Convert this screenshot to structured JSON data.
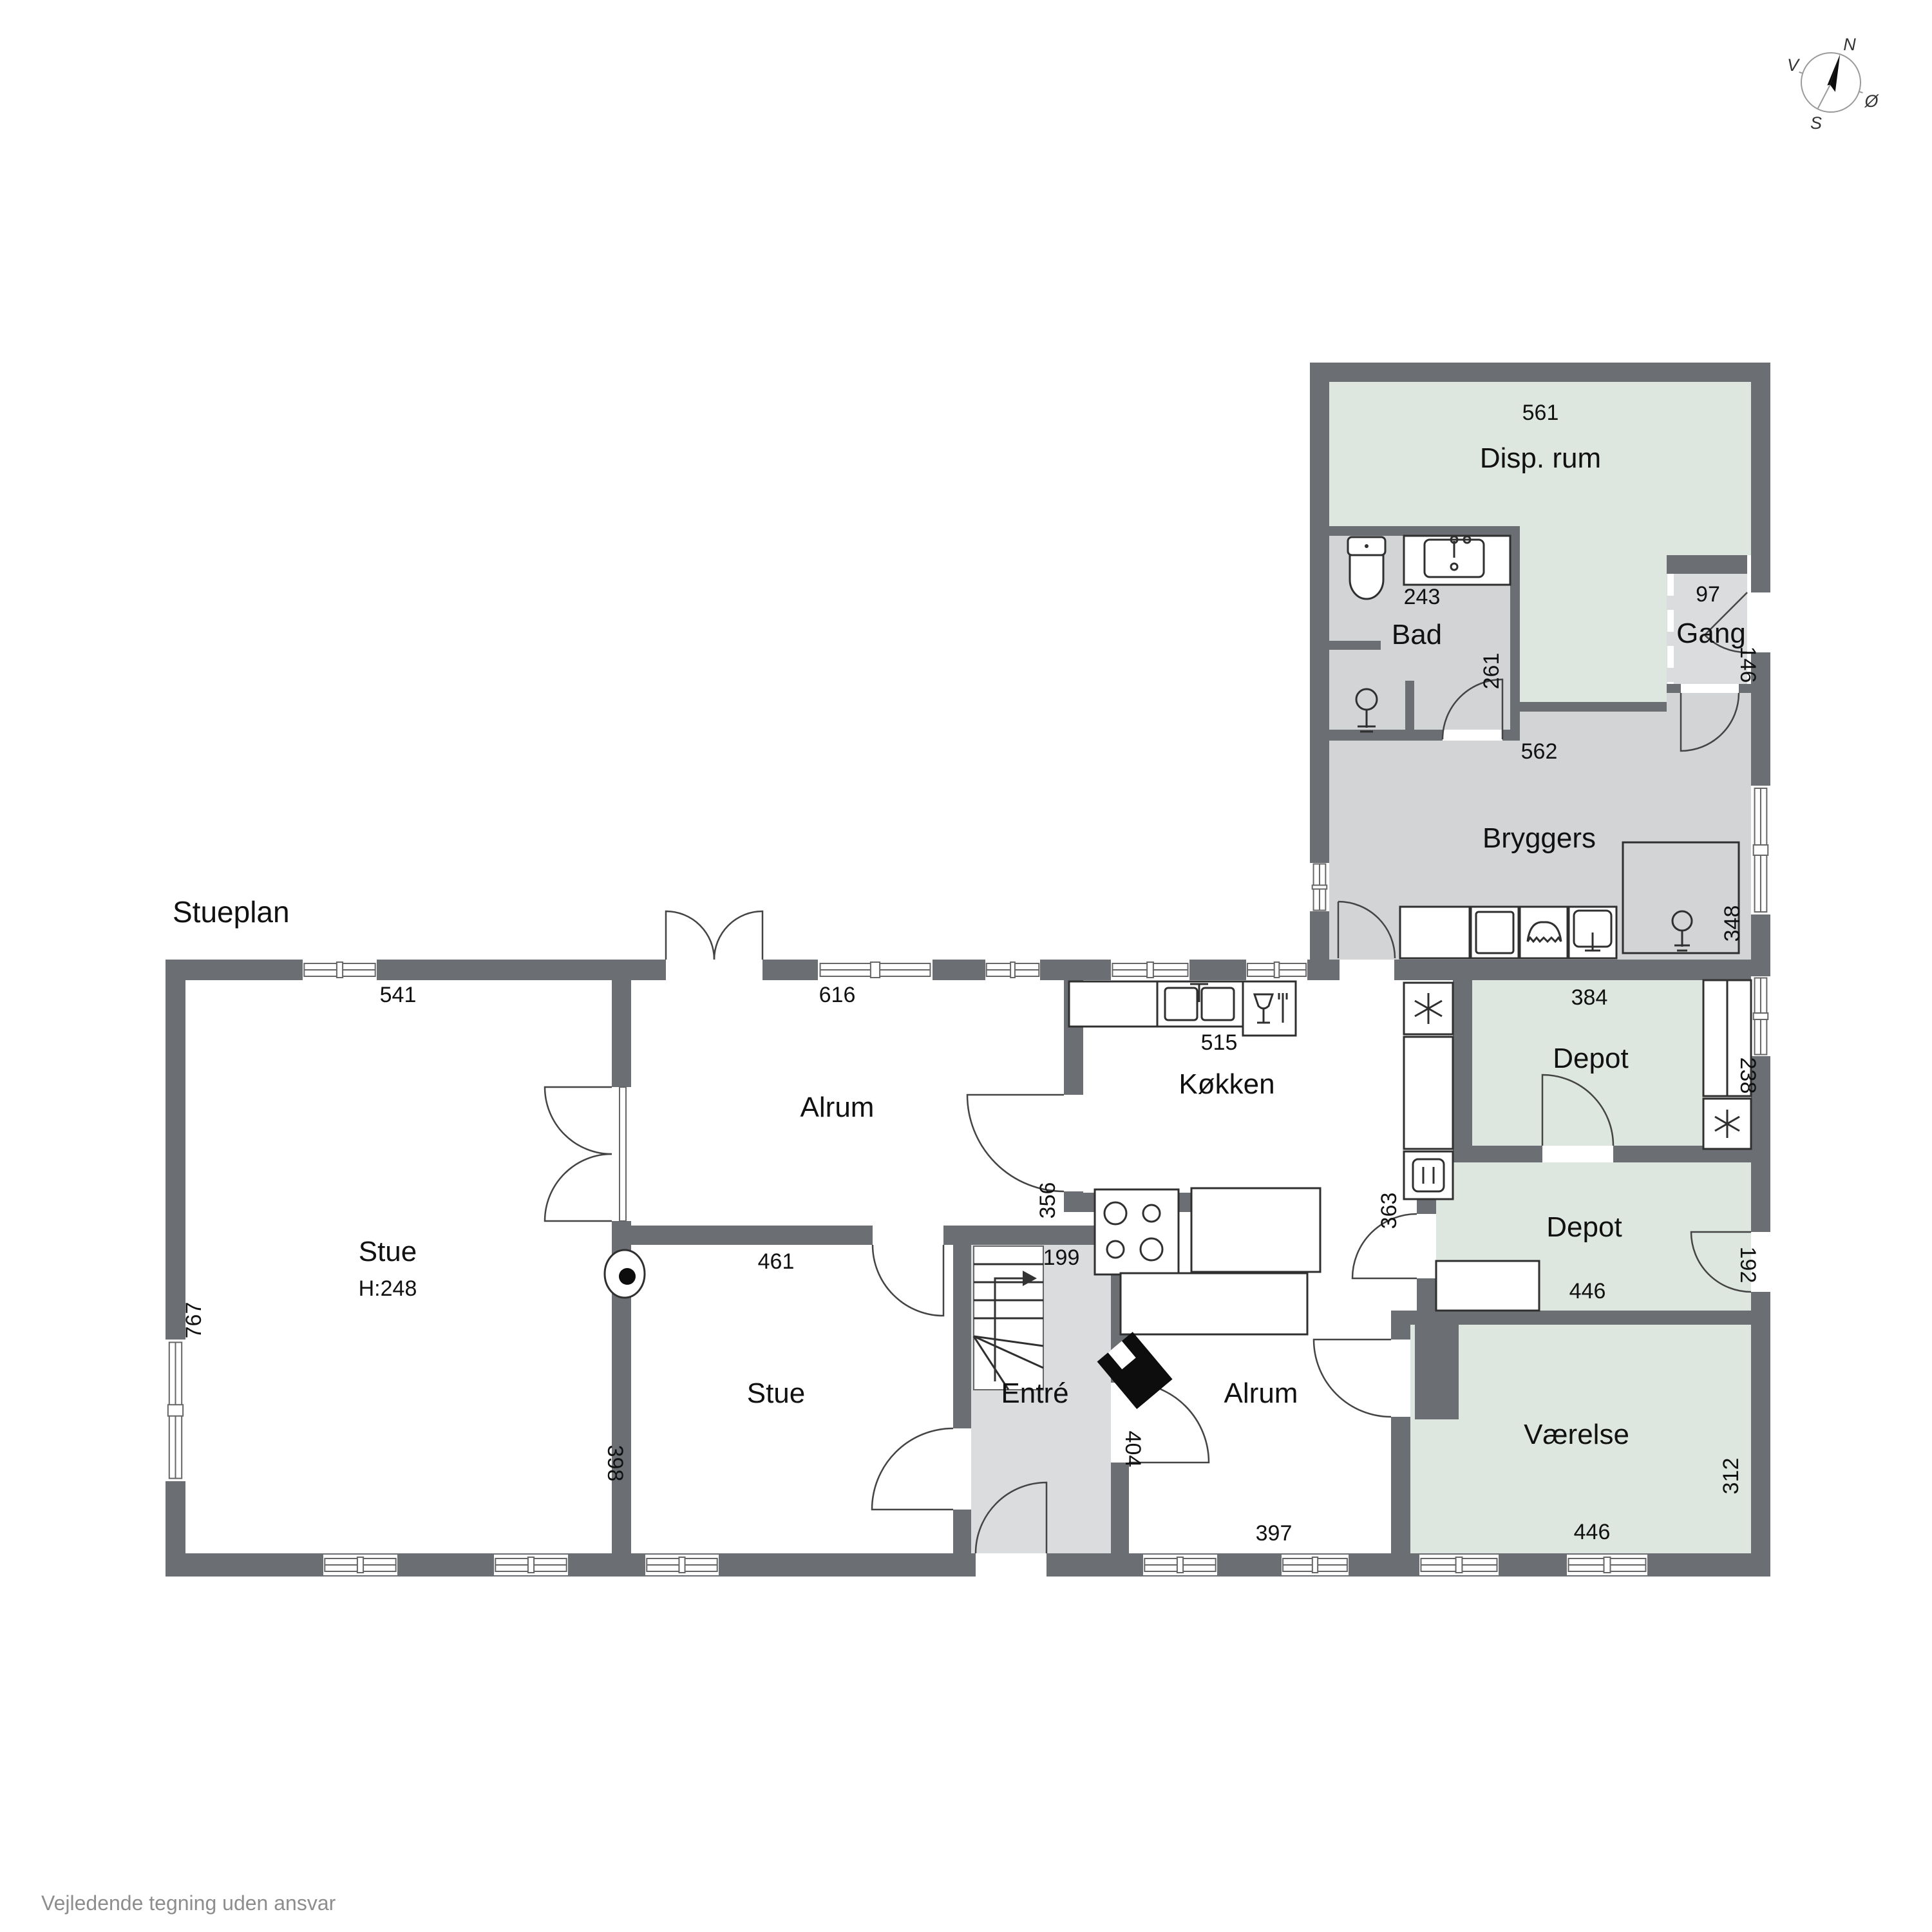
{
  "page": {
    "title": "Stueplan",
    "footer": "Vejledende tegning uden ansvar"
  },
  "compass": {
    "north": "N",
    "south": "S",
    "east": "Ø",
    "west": "V"
  },
  "rooms": {
    "disp_rum": {
      "label": "Disp. rum",
      "dims": {
        "width": "561"
      }
    },
    "bad": {
      "label": "Bad",
      "dims": {
        "vanity": "243",
        "door_side": "261"
      }
    },
    "gang": {
      "label": "Gang",
      "dims": {
        "width": "97",
        "height": "146"
      }
    },
    "bryggers": {
      "label": "Bryggers",
      "dims": {
        "width": "562",
        "right": "348"
      }
    },
    "koekken": {
      "label": "Køkken",
      "dims": {
        "counter": "515",
        "right": "363"
      }
    },
    "alrum_top": {
      "label": "Alrum",
      "dims": {
        "width": "616",
        "right": "356"
      }
    },
    "stue_left": {
      "label": "Stue",
      "ceiling": "H:248",
      "dims": {
        "width": "541",
        "left": "767"
      }
    },
    "stue_bottom": {
      "label": "Stue",
      "dims": {
        "width": "461",
        "left": "398"
      }
    },
    "entre": {
      "label": "Entré",
      "dims": {
        "width": "199"
      }
    },
    "alrum_bottom": {
      "label": "Alrum",
      "dims": {
        "left": "404",
        "bottom": "397"
      }
    },
    "depot_north": {
      "label": "Depot",
      "dims": {
        "width": "384",
        "right": "238"
      }
    },
    "depot_south": {
      "label": "Depot",
      "dims": {
        "width": "446",
        "right": "192"
      }
    },
    "vaerelse": {
      "label": "Værelse",
      "dims": {
        "top": "446",
        "bottom": "446",
        "right": "312"
      }
    }
  }
}
